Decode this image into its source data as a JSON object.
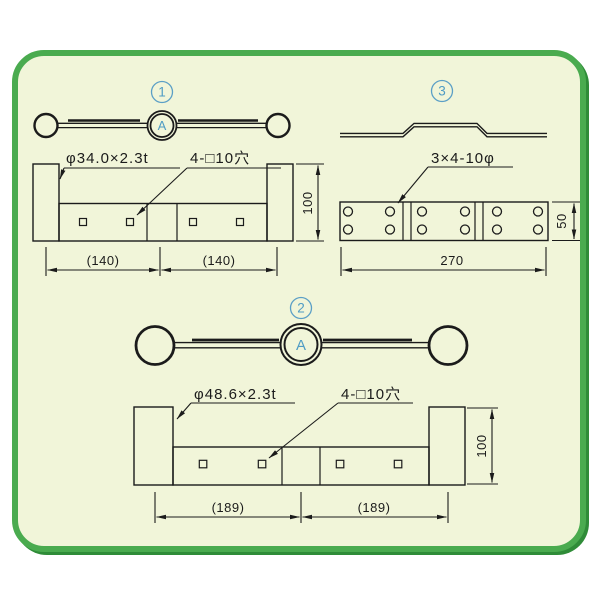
{
  "colors": {
    "panel_background": "#f1f5d9",
    "panel_border": "#4aab4f",
    "panel_shadow": "#2f8c38",
    "line": "#1b1b1b",
    "accent_blue": "#4f9cc4"
  },
  "d1": {
    "num": "1",
    "a": "A",
    "spec": "φ34.0×2.3t",
    "holes": "4-□10穴",
    "dimL": "(140)",
    "dimR": "(140)",
    "h": "100"
  },
  "d2": {
    "num": "2",
    "a": "A",
    "spec": "φ48.6×2.3t",
    "holes": "4-□10穴",
    "dimL": "(189)",
    "dimR": "(189)",
    "h": "100"
  },
  "d3": {
    "num": "3",
    "holes": "3×4-10φ",
    "w": "270",
    "h": "50"
  }
}
